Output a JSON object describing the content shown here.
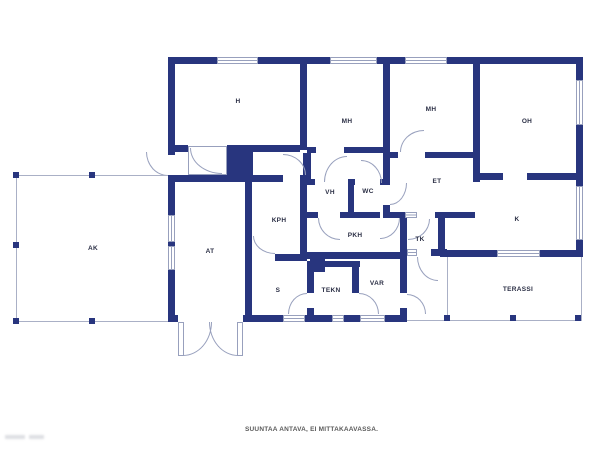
{
  "plan": {
    "caption": "SUUNTAA ANTAVA, EI MITTAKAAVASSA.",
    "rooms": [
      {
        "id": "h",
        "label": "H"
      },
      {
        "id": "mh-1",
        "label": "MH"
      },
      {
        "id": "mh-2",
        "label": "MH"
      },
      {
        "id": "oh",
        "label": "OH"
      },
      {
        "id": "ak",
        "label": "AK"
      },
      {
        "id": "at",
        "label": "AT"
      },
      {
        "id": "kph",
        "label": "KPH"
      },
      {
        "id": "vh",
        "label": "VH"
      },
      {
        "id": "wc",
        "label": "WC"
      },
      {
        "id": "et",
        "label": "ET"
      },
      {
        "id": "k",
        "label": "K"
      },
      {
        "id": "pkh",
        "label": "PKH"
      },
      {
        "id": "tk",
        "label": "TK"
      },
      {
        "id": "s",
        "label": "S"
      },
      {
        "id": "tekn",
        "label": "TEKN"
      },
      {
        "id": "var",
        "label": "VAR"
      },
      {
        "id": "terassi",
        "label": "TERASSI"
      }
    ],
    "colors": {
      "wall": "#28357e",
      "line": "#98a0bd",
      "label": "#2b2f45",
      "caption": "#5a5a5a"
    }
  }
}
